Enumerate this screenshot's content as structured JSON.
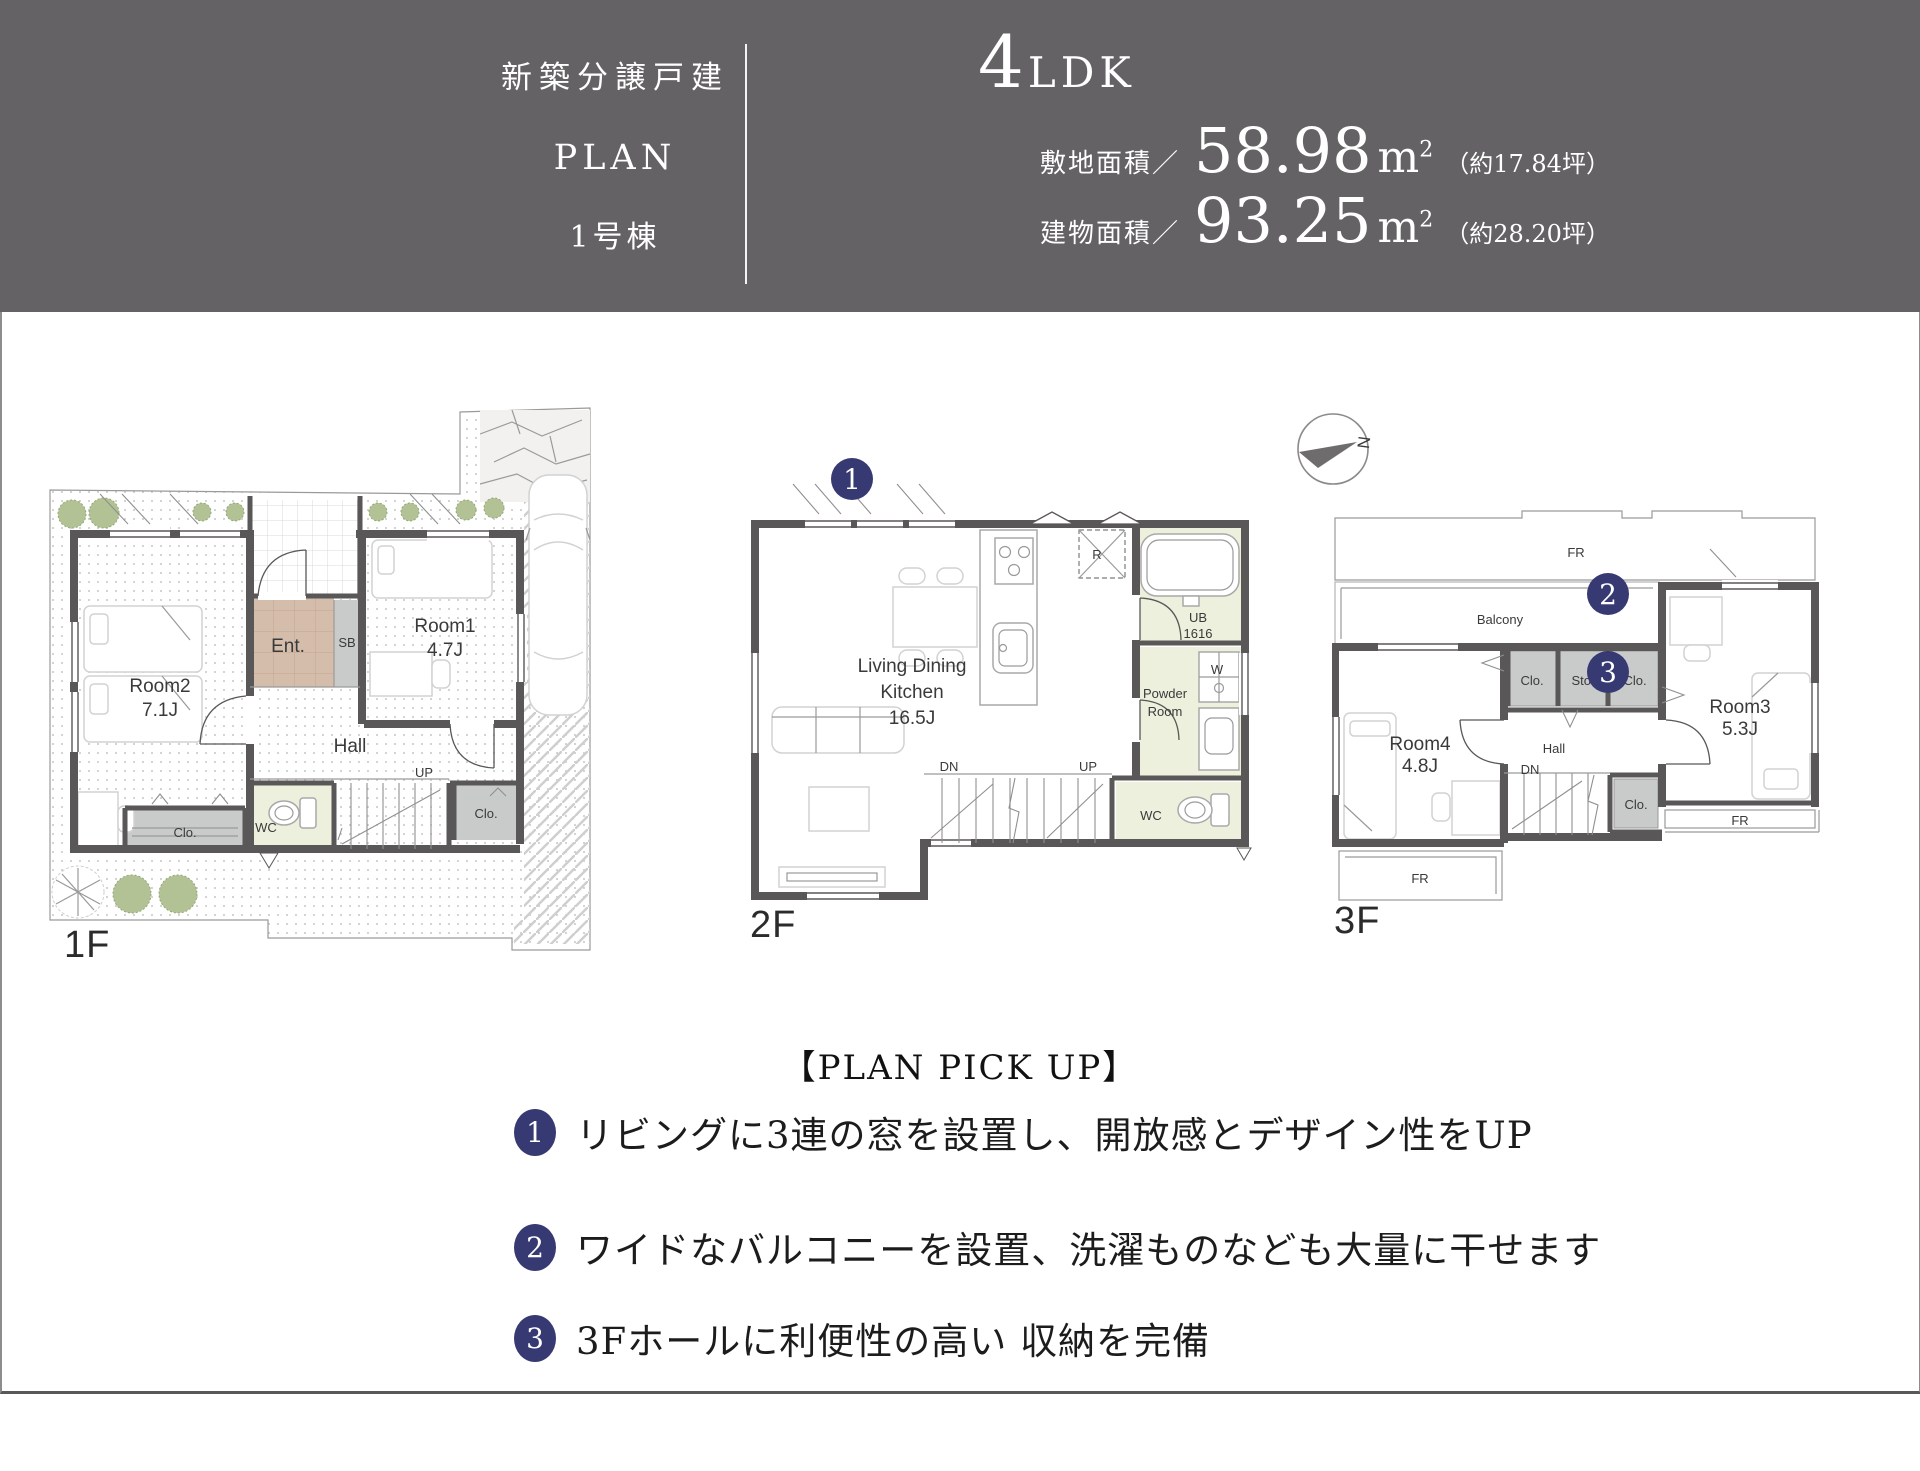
{
  "header": {
    "type_label": "新築分譲戸建",
    "plan_label": "PLAN",
    "building_label": "1号棟",
    "ldk_number": "4",
    "ldk_text": "LDK",
    "site": {
      "label": "敷地面積／",
      "value": "58.98",
      "unit": "m",
      "sup": "2",
      "tsubo": "（約17.84坪）"
    },
    "building_area": {
      "label": "建物面積／",
      "value": "93.25",
      "unit": "m",
      "sup": "2",
      "tsubo": "（約28.20坪）"
    }
  },
  "floors": {
    "f1": {
      "label": "1F",
      "room1": "Room1",
      "room1_size": "4.7J",
      "room2": "Room2",
      "room2_size": "7.1J",
      "ent": "Ent.",
      "sb": "SB",
      "hall": "Hall",
      "up": "UP",
      "wc": "WC",
      "clo_left": "Clo.",
      "clo_right": "Clo."
    },
    "f2": {
      "label": "2F",
      "badge": "1",
      "ldk_line1": "Living Dining",
      "ldk_line2": "Kitchen",
      "ldk_size": "16.5J",
      "r": "R",
      "ub_line1": "UB",
      "ub_line2": "1616",
      "powder_line1": "Powder",
      "powder_line2": "Room",
      "w": "W",
      "dn": "DN",
      "up": "UP",
      "wc": "WC"
    },
    "f3": {
      "label": "3F",
      "badge2": "2",
      "badge3": "3",
      "fr_top": "FR",
      "balcony": "Balcony",
      "clo_a": "Clo.",
      "sto": "Sto.",
      "clo_b": "Clo.",
      "room3": "Room3",
      "room3_size": "5.3J",
      "room4": "Room4",
      "room4_size": "4.8J",
      "hall": "Hall",
      "dn": "DN",
      "clo_c": "Clo.",
      "fr_right": "FR",
      "fr_bottom": "FR"
    },
    "compass_n": "N"
  },
  "pickup": {
    "heading": "【PLAN PICK UP】",
    "items": [
      {
        "num": "1",
        "text": "リビングに3連の窓を設置し、開放感とデザイン性をUP"
      },
      {
        "num": "2",
        "text": "ワイドなバルコニーを設置、洗濯ものなども大量に干せます"
      },
      {
        "num": "3",
        "text": "3Fホールに利便性の高い 収納を完備"
      }
    ]
  },
  "colors": {
    "header_bg": "#646264",
    "badge_navy": "#373a72",
    "wall": "#595757",
    "wet_area": "#edf0dd",
    "entrance_tile": "#d5bdab",
    "closet_gray": "#c9caca",
    "tree_green": "#b3c295"
  }
}
